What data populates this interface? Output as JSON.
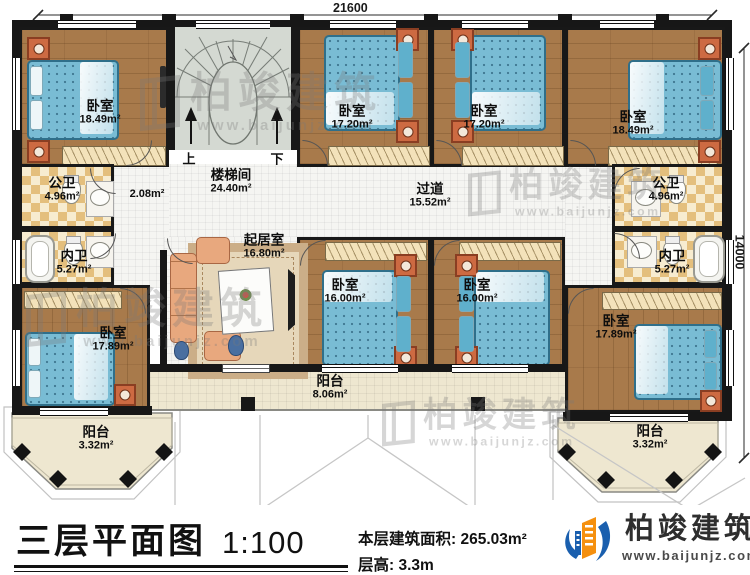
{
  "dimensions": {
    "width": "21600",
    "height": "14000"
  },
  "stairs": {
    "up": "上",
    "down": "下"
  },
  "rooms": {
    "bedroom_tl": {
      "name": "卧室",
      "area": "18.49m²"
    },
    "stairwell": {
      "name": "楼梯间",
      "area": "24.40m²"
    },
    "hall": {
      "area": "2.08m²"
    },
    "bedroom_t2": {
      "name": "卧室",
      "area": "17.20m²"
    },
    "bedroom_t3": {
      "name": "卧室",
      "area": "17.20m²"
    },
    "bedroom_tr": {
      "name": "卧室",
      "area": "18.49m²"
    },
    "pub_bath_left": {
      "name": "公卫",
      "area": "4.96m²"
    },
    "pub_bath_right": {
      "name": "公卫",
      "area": "4.96m²"
    },
    "corridor": {
      "name": "过道",
      "area": "15.52m²"
    },
    "priv_bath_left": {
      "name": "内卫",
      "area": "5.27m²"
    },
    "priv_bath_right": {
      "name": "内卫",
      "area": "5.27m²"
    },
    "living_room": {
      "name": "起居室",
      "area": "16.80m²"
    },
    "bedroom_bl": {
      "name": "卧室",
      "area": "17.89m²"
    },
    "bedroom_bm1": {
      "name": "卧室",
      "area": "16.00m²"
    },
    "bedroom_bm2": {
      "name": "卧室",
      "area": "16.00m²"
    },
    "bedroom_br": {
      "name": "卧室",
      "area": "17.89m²"
    },
    "balcony_left": {
      "name": "阳台",
      "area": "3.32m²"
    },
    "balcony_center": {
      "name": "阳台",
      "area": "8.06m²"
    },
    "balcony_right": {
      "name": "阳台",
      "area": "3.32m²"
    }
  },
  "footer": {
    "title": "三层平面图",
    "scale": "1:100",
    "area_line": "本层建筑面积: 265.03m²",
    "height_line": "层高: 3.3m"
  },
  "brand": {
    "name": "柏竣建筑",
    "url": "www.baijunjz.com"
  },
  "watermark": {
    "text": "柏竣建筑",
    "url": "www.baijunjz.com"
  },
  "colors": {
    "wall": "#171717",
    "wood": "#a87a4b",
    "bed": "#79bcd4",
    "brand_blue": "#1a5fae",
    "brand_orange": "#f5900f"
  }
}
